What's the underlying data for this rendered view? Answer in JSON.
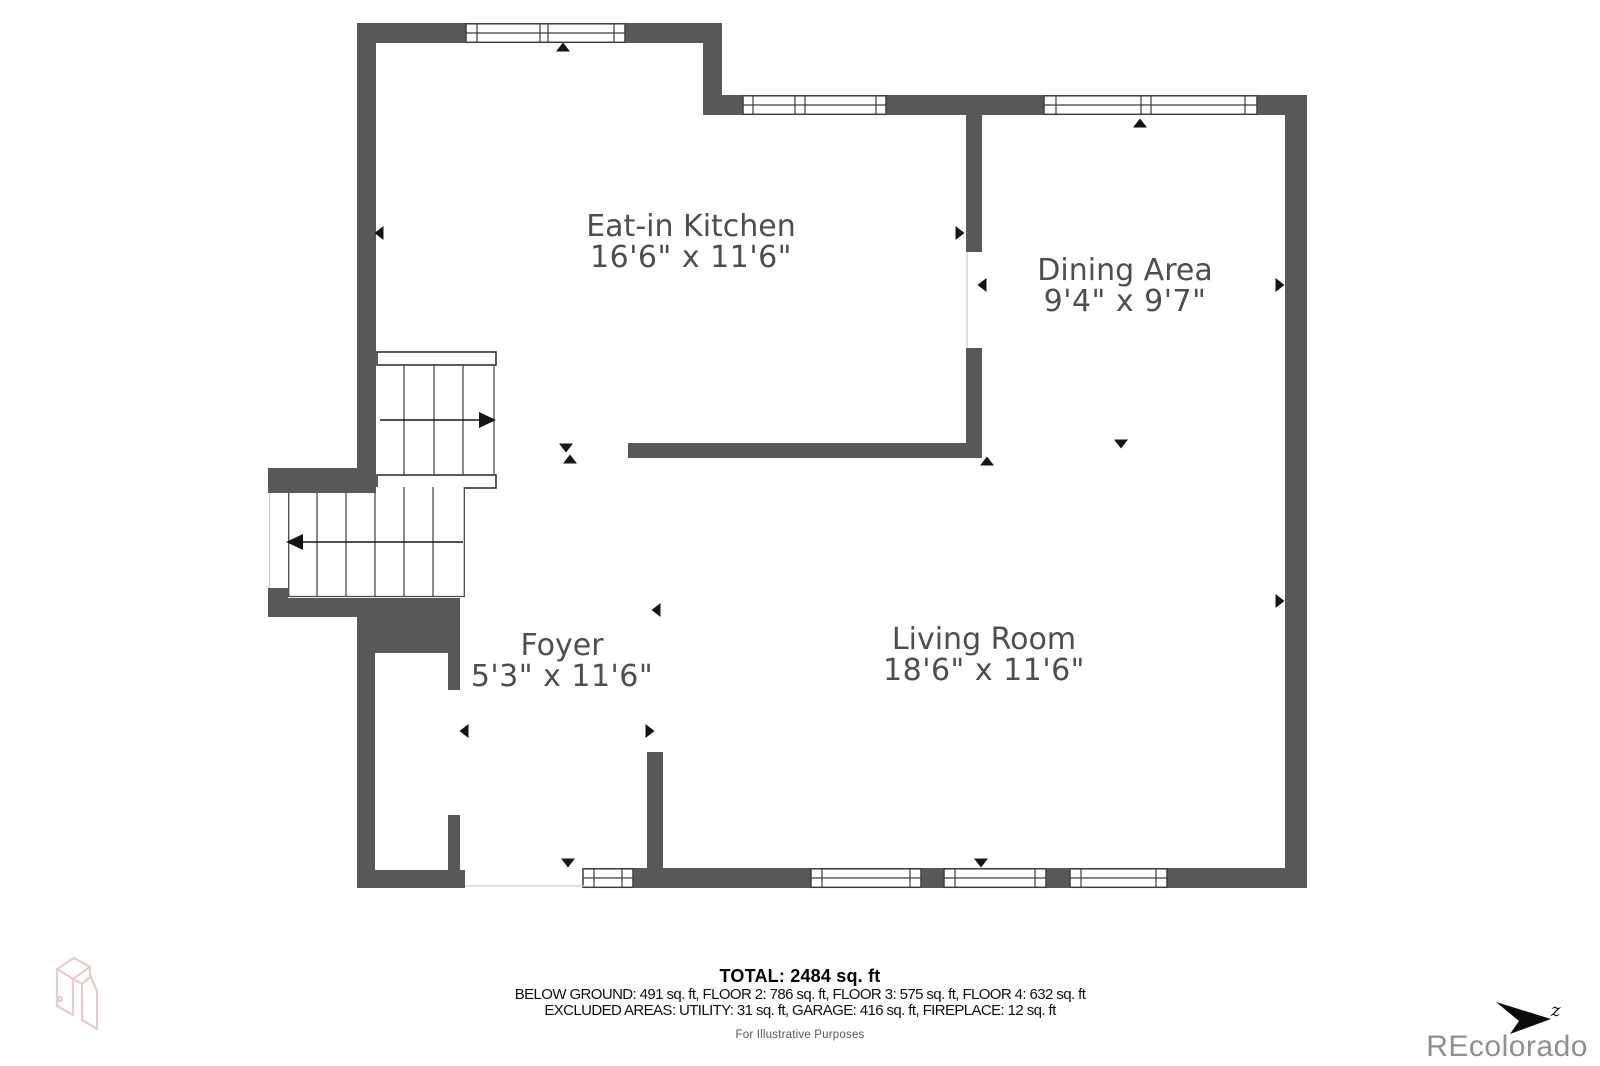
{
  "rooms": [
    {
      "id": "kitchen",
      "name": "Eat-in Kitchen",
      "dims": "16'6\" x 11'6\""
    },
    {
      "id": "dining",
      "name": "Dining Area",
      "dims": "9'4\" x 9'7\""
    },
    {
      "id": "foyer",
      "name": "Foyer",
      "dims": "5'3\" x 11'6\""
    },
    {
      "id": "living",
      "name": "Living Room",
      "dims": "18'6\" x 11'6\""
    }
  ],
  "summary": {
    "total": "TOTAL: 2484 sq. ft",
    "floors": "BELOW GROUND: 491 sq. ft, FLOOR 2: 786 sq. ft, FLOOR 3: 575 sq. ft, FLOOR 4: 632 sq. ft",
    "excluded": "EXCLUDED AREAS: UTILITY: 31 sq. ft, GARAGE: 416 sq. ft, FIREPLACE: 12 sq. ft",
    "disclaimer": "For Illustrative Purposes"
  },
  "watermark": "REcolorado",
  "compass": {
    "label": "z"
  },
  "colors": {
    "wall": "#585858",
    "window_frame": "#3e3e3e",
    "label_text": "#4e4e4e",
    "arrow": "#151515",
    "watermark": "#8f8f8f",
    "logo_pink": "#e9cbcb"
  }
}
